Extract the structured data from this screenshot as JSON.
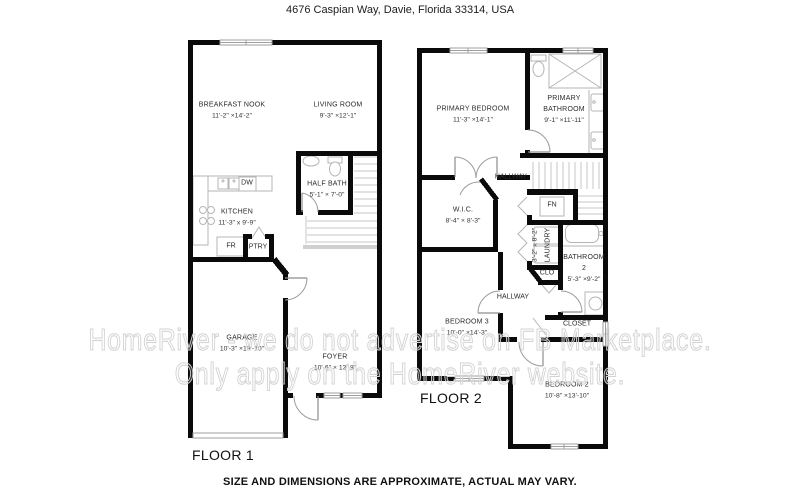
{
  "title": "4676 Caspian Way, Davie, Florida 33314, USA",
  "disclaimer": "SIZE AND DIMENSIONS ARE APPROXIMATE, ACTUAL MAY VARY.",
  "watermark": {
    "line1": "HomeRiver - we do not advertise on FB Marketplace.",
    "line2": "Only apply on the HomeRiver website."
  },
  "colors": {
    "wall": "#0a0a0a",
    "fixture_line": "#b5b5b5",
    "stair_line": "#c7c7c7",
    "door_line": "#9c9c9c",
    "text": "#2b2b2b",
    "watermark_stroke": "#d3d3d3"
  },
  "floor1": {
    "label": "FLOOR 1",
    "rooms": {
      "breakfast_nook": {
        "name": "BREAKFAST NOOK",
        "dims": "11'-2\" ×14'-2\""
      },
      "living_room": {
        "name": "LIVING ROOM",
        "dims": "9'-3\" ×12'-1\""
      },
      "half_bath": {
        "name": "HALF BATH",
        "dims": "5'-1\" × 7'-0\""
      },
      "kitchen": {
        "name": "KITCHEN",
        "dims": "11'-3\" x 9'-9\""
      },
      "garage": {
        "name": "GARAGE",
        "dims": "10'-3\" ×19'-10\""
      },
      "foyer": {
        "name": "FOYER",
        "dims": "10'-6\" × 13'-8\""
      }
    },
    "fixtures": {
      "dw": "DW",
      "fr": "FR",
      "ptry": "PTRY"
    }
  },
  "floor2": {
    "label": "FLOOR 2",
    "rooms": {
      "primary_bedroom": {
        "name": "PRIMARY BEDROOM",
        "dims": "11'-3\" ×14'-1\""
      },
      "primary_bathroom": {
        "name": "PRIMARY BATHROOM",
        "dims": "9'-1\" ×11'-11\""
      },
      "hallway_top": {
        "name": "HALLWAY"
      },
      "wic": {
        "name": "W.I.C.",
        "dims": "8'-4\" × 8'-3\""
      },
      "laundry": {
        "name": "LAUNDRY",
        "dims": "3'-2\" x 8'-2\""
      },
      "bathroom2": {
        "name": "BATHROOM 2",
        "dims": "5'-3\" ×9'-2\""
      },
      "hallway_bottom": {
        "name": "HALLWAY"
      },
      "bedroom3": {
        "name": "BEDROOM 3",
        "dims": "10'-0\" ×14'-3\""
      },
      "closet": {
        "name": "CLOSET"
      },
      "bedroom2": {
        "name": "BEDROOM 2",
        "dims": "10'-8\" ×13'-10\""
      }
    },
    "fixtures": {
      "fn": "FN",
      "clo": "CLO"
    }
  }
}
